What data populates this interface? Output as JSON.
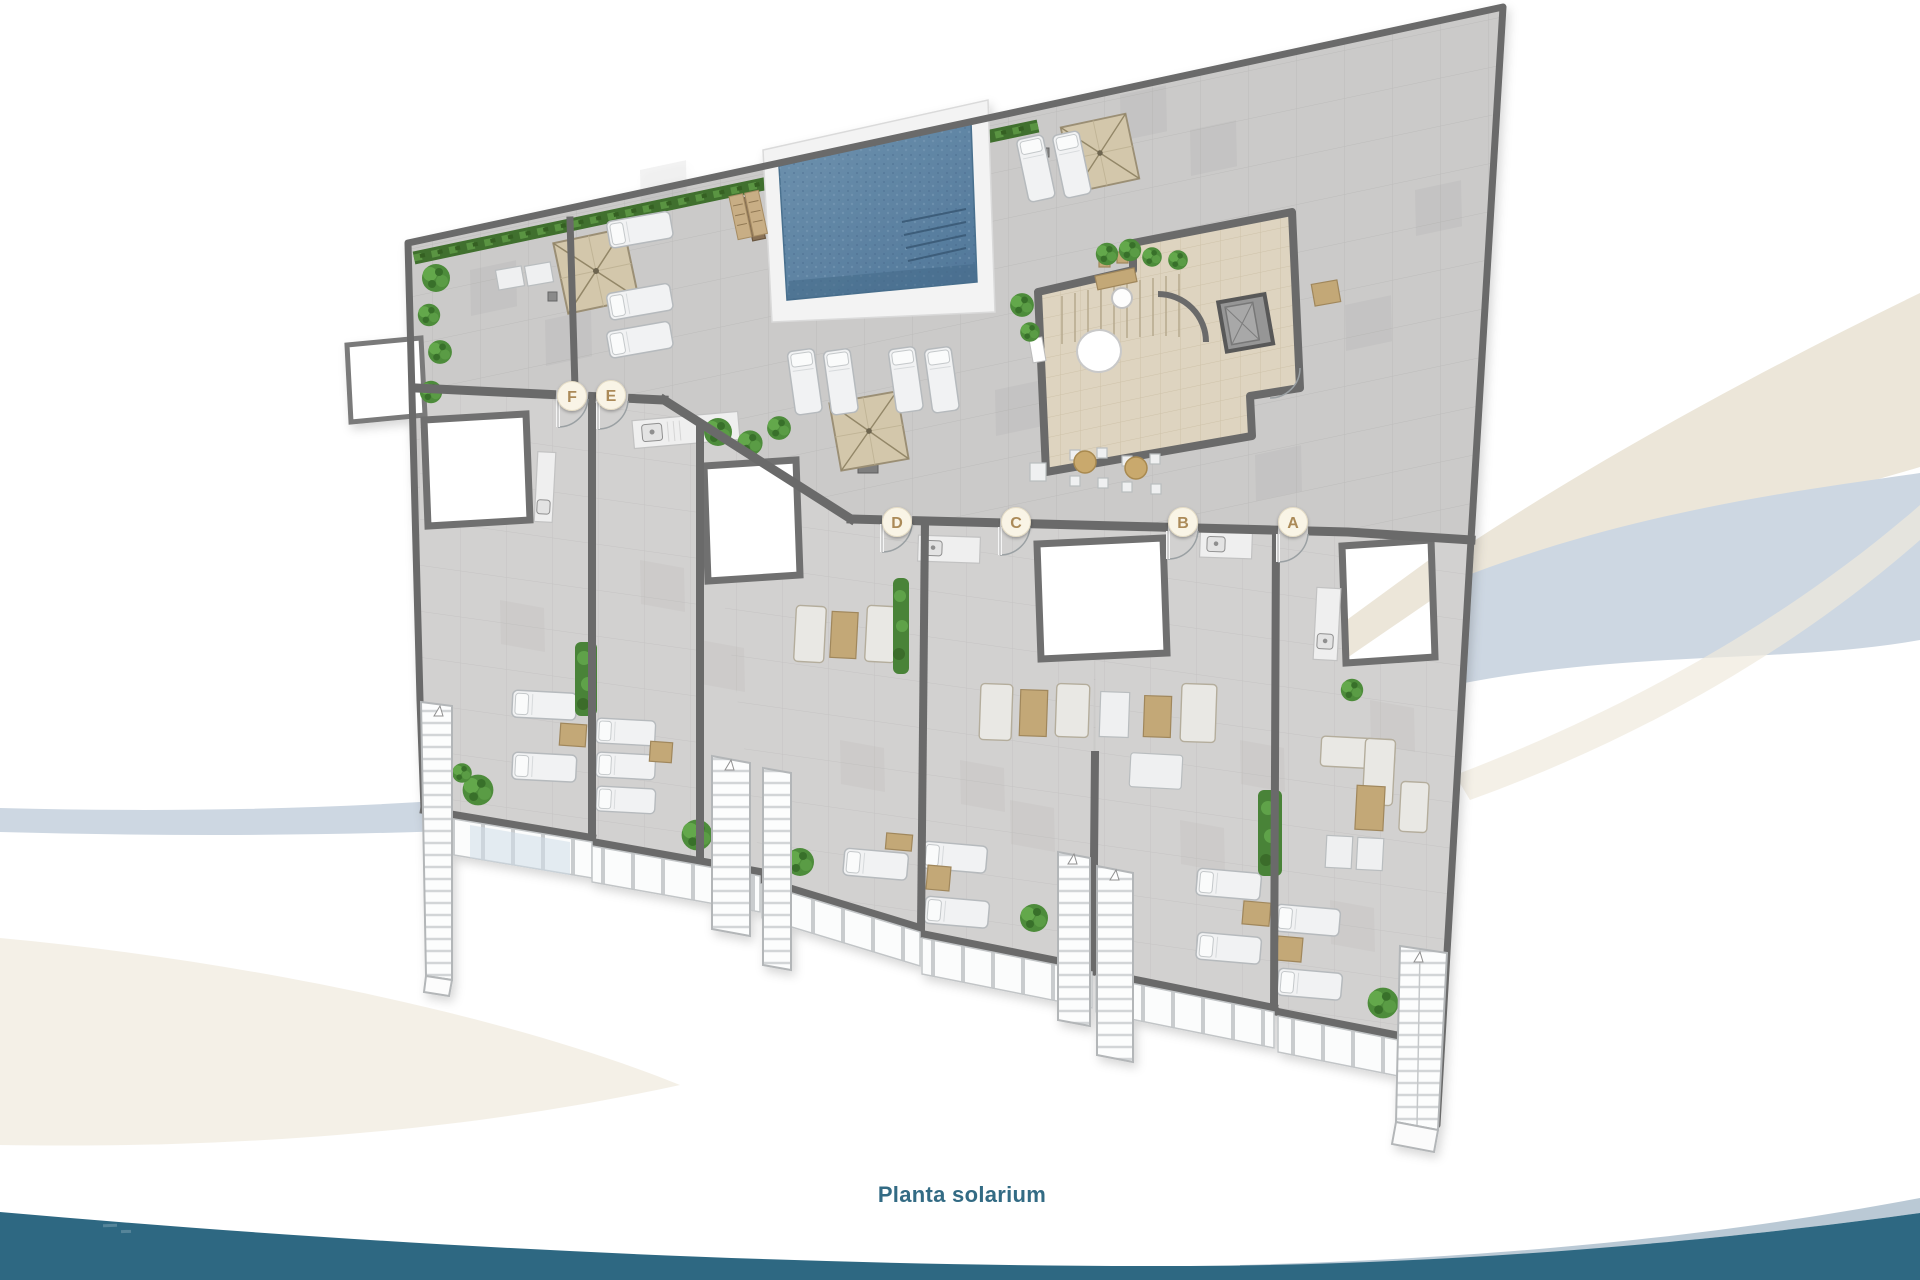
{
  "page": {
    "background_color": "#ffffff",
    "caption": "Planta solarium",
    "caption_color": "#336b84"
  },
  "plan": {
    "type": "rooftop-solarium-floor-plan",
    "unit_count": 6,
    "units": [
      {
        "label": "F"
      },
      {
        "label": "E"
      },
      {
        "label": "D"
      },
      {
        "label": "C"
      },
      {
        "label": "B"
      },
      {
        "label": "A"
      }
    ],
    "features": [
      "swimming-pool",
      "pool-steps",
      "outdoor-shower",
      "parasols",
      "sun-loungers",
      "stair-core",
      "elevator",
      "round-tables",
      "bar-counter",
      "kitchenette-sinks",
      "private-terraces",
      "skylight-openings",
      "planters",
      "hedge",
      "bushes",
      "exterior-staircases",
      "railings"
    ]
  },
  "colors": {
    "wall": "#6a6a6a",
    "deck_tile": "#cbcac9",
    "terrace_tile": "#d2d1d0",
    "pool_water": "#5d82a0",
    "core_floor": "#ded4c0",
    "parasol": "#d3c7ab",
    "greenery": "#4e8c3a",
    "badge_fill": "#f9f4e6",
    "badge_letter": "#ab8a58",
    "swoosh_beige": "#ece6d9",
    "swoosh_blue": "#cdd7e2",
    "footer_wave": "#2e6882"
  }
}
